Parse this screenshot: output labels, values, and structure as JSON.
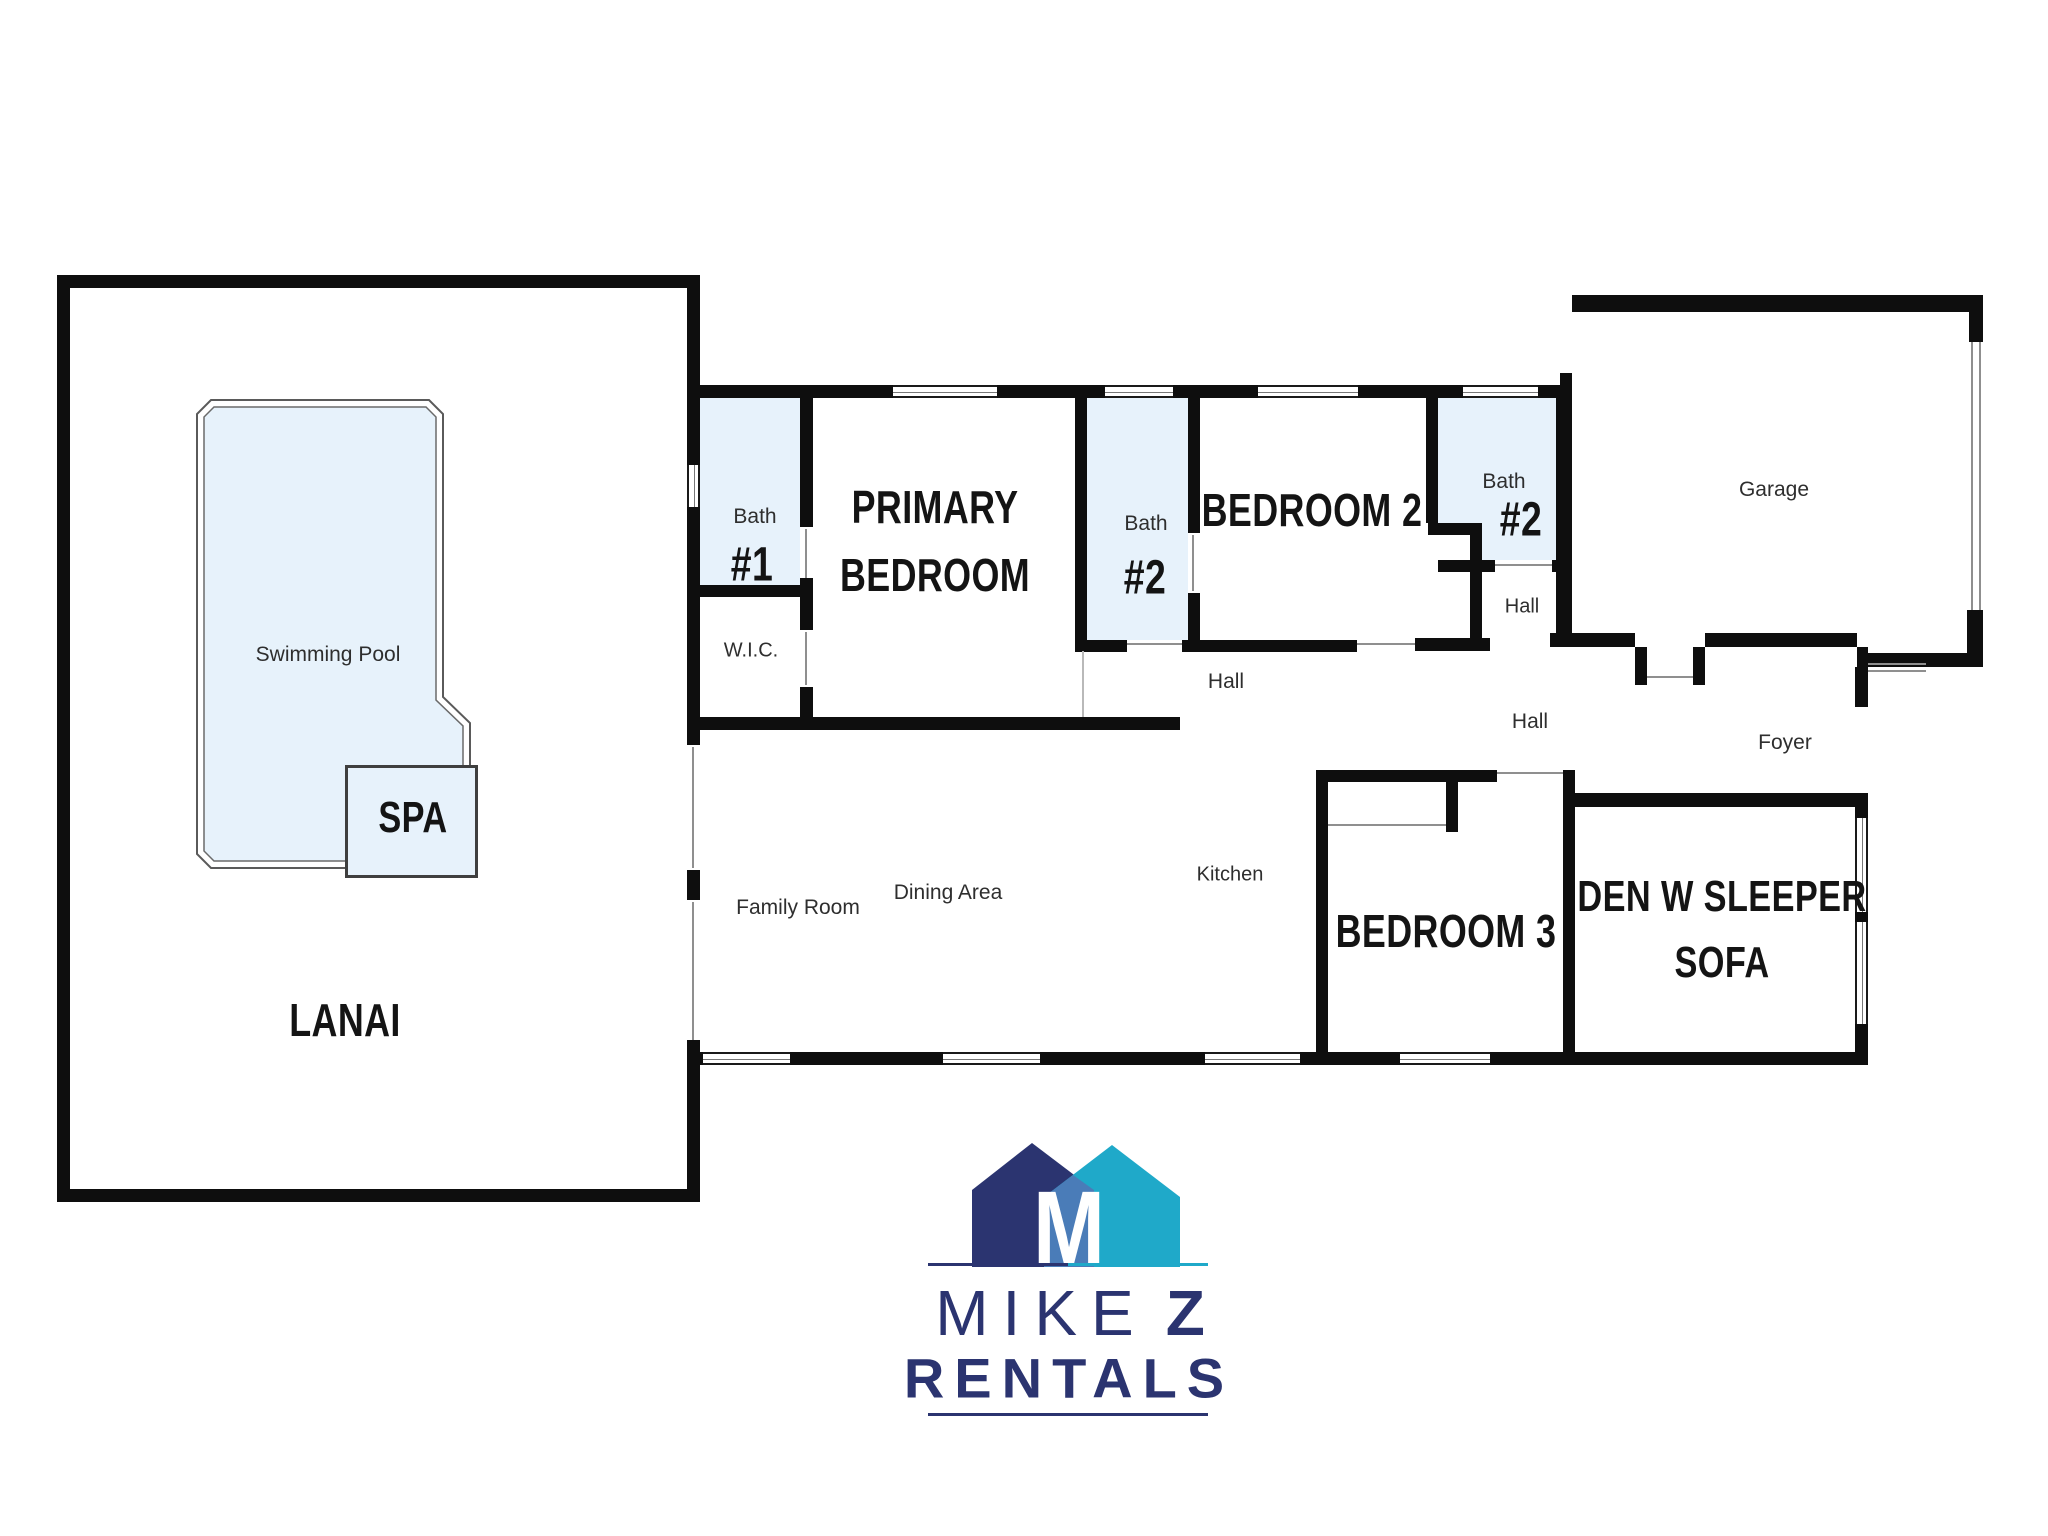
{
  "rooms": {
    "lanai": {
      "label": "LANAI"
    },
    "swimming_pool": {
      "label": "Swimming Pool"
    },
    "spa": {
      "label": "SPA"
    },
    "bath1": {
      "name": "Bath",
      "number": "#1"
    },
    "wic": {
      "label": "W.I.C."
    },
    "primary_bedroom": {
      "lines": [
        "PRIMARY",
        "BEDROOM"
      ]
    },
    "bath2a": {
      "name": "Bath",
      "number": "#2"
    },
    "bedroom2": {
      "label": "BEDROOM 2"
    },
    "bath2b": {
      "name": "Bath",
      "number": "#2"
    },
    "hall_upper": {
      "label": "Hall"
    },
    "hall_main": {
      "label": "Hall"
    },
    "hall_east": {
      "label": "Hall"
    },
    "garage": {
      "label": "Garage"
    },
    "foyer": {
      "label": "Foyer"
    },
    "family_room": {
      "label": "Family Room"
    },
    "dining_area": {
      "label": "Dining Area"
    },
    "kitchen": {
      "label": "Kitchen"
    },
    "bedroom3": {
      "label": "BEDROOM 3"
    },
    "den": {
      "lines": [
        "DEN W SLEEPER",
        "SOFA"
      ]
    }
  },
  "logo": {
    "monogram": "M",
    "word1": "MIKE",
    "word2": "Z",
    "word3": "RENTALS"
  },
  "colors": {
    "wall": "#0e0e0e",
    "roomfill": "#e7f2fb",
    "navy": "#2b3470",
    "teal": "#1fa9c9",
    "midblue": "#4a7cb8",
    "label_text": "#2e2e2e"
  }
}
